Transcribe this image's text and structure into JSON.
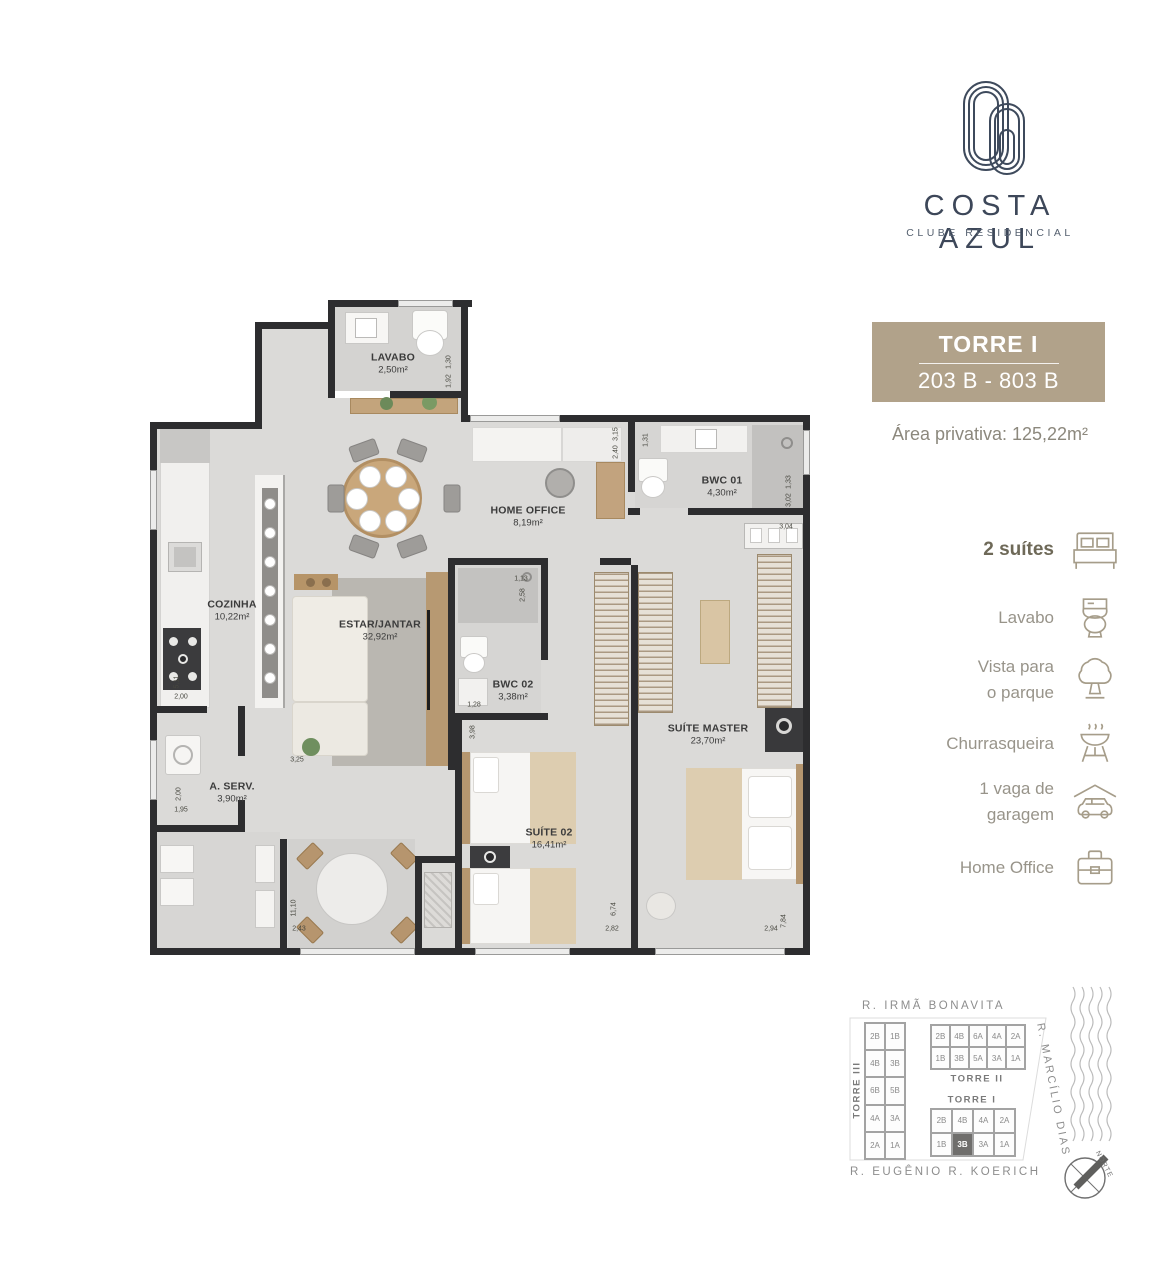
{
  "brand": {
    "name": "COSTA AZUL",
    "tagline": "CLUBE RESIDENCIAL"
  },
  "unit_card": {
    "tower": "TORRE I",
    "range": "203 B - 803 B",
    "private_area": "Área privativa: 125,22m²"
  },
  "features": [
    {
      "line1": "2 suítes",
      "line2": "",
      "icon": "bed-icon"
    },
    {
      "line1": "Lavabo",
      "line2": "",
      "icon": "toilet-icon"
    },
    {
      "line1": "Vista para",
      "line2": "o parque",
      "icon": "tree-icon"
    },
    {
      "line1": "Churrasqueira",
      "line2": "",
      "icon": "grill-icon"
    },
    {
      "line1": "1 vaga de",
      "line2": "garagem",
      "icon": "car-icon"
    },
    {
      "line1": "Home Office",
      "line2": "",
      "icon": "briefcase-icon"
    }
  ],
  "floor_plan": {
    "rooms": [
      {
        "name": "LAVABO",
        "area": "2,50m²"
      },
      {
        "name": "COZINHA",
        "area": "10,22m²"
      },
      {
        "name": "HOME OFFICE",
        "area": "8,19m²"
      },
      {
        "name": "BWC 01",
        "area": "4,30m²"
      },
      {
        "name": "ESTAR/JANTAR",
        "area": "32,92m²"
      },
      {
        "name": "BWC 02",
        "area": "3,38m²"
      },
      {
        "name": "A. SERV.",
        "area": "3,90m²"
      },
      {
        "name": "SUÍTE MASTER",
        "area": "23,70m²"
      },
      {
        "name": "SUÍTE 02",
        "area": "16,41m²"
      }
    ],
    "dimensions": [
      "1,30",
      "1,92",
      "3,15",
      "2,40",
      "1,31",
      "1,33",
      "3,02",
      "3,04",
      "5,11",
      "2,00",
      "2,00",
      "1,95",
      "3,25",
      "1,13",
      "2,58",
      "1,28",
      "3,98",
      "11,10",
      "2,43",
      "2,82",
      "6,74",
      "2,94",
      "7,84"
    ]
  },
  "site_map": {
    "streets": {
      "top": "R. IRMÃ BONAVITA",
      "right": "R. MARCÍLIO DIAS",
      "bottom": "R. EUGÊNIO R. KOERICH"
    },
    "north_label": "NORTE",
    "towers": [
      {
        "name": "TORRE III",
        "rows": [
          [
            "2B",
            "1B"
          ],
          [
            "4B",
            "3B"
          ],
          [
            "6B",
            "5B"
          ],
          [
            "4A",
            "3A"
          ],
          [
            "2A",
            "1A"
          ]
        ],
        "highlighted": ""
      },
      {
        "name": "TORRE II",
        "rows": [
          [
            "2B",
            "4B",
            "6A",
            "4A",
            "2A"
          ],
          [
            "1B",
            "3B",
            "5A",
            "3A",
            "1A"
          ]
        ],
        "highlighted": ""
      },
      {
        "name": "TORRE I",
        "rows": [
          [
            "2B",
            "4B",
            "4A",
            "2A"
          ],
          [
            "1B",
            "3B",
            "3A",
            "1A"
          ]
        ],
        "highlighted": "3B"
      }
    ]
  },
  "colors": {
    "accent_tan": "#b1a28a",
    "logo_navy": "#3e4a5c",
    "wall": "#2d2d2f",
    "highlight_cell": "#6f6e6c"
  }
}
